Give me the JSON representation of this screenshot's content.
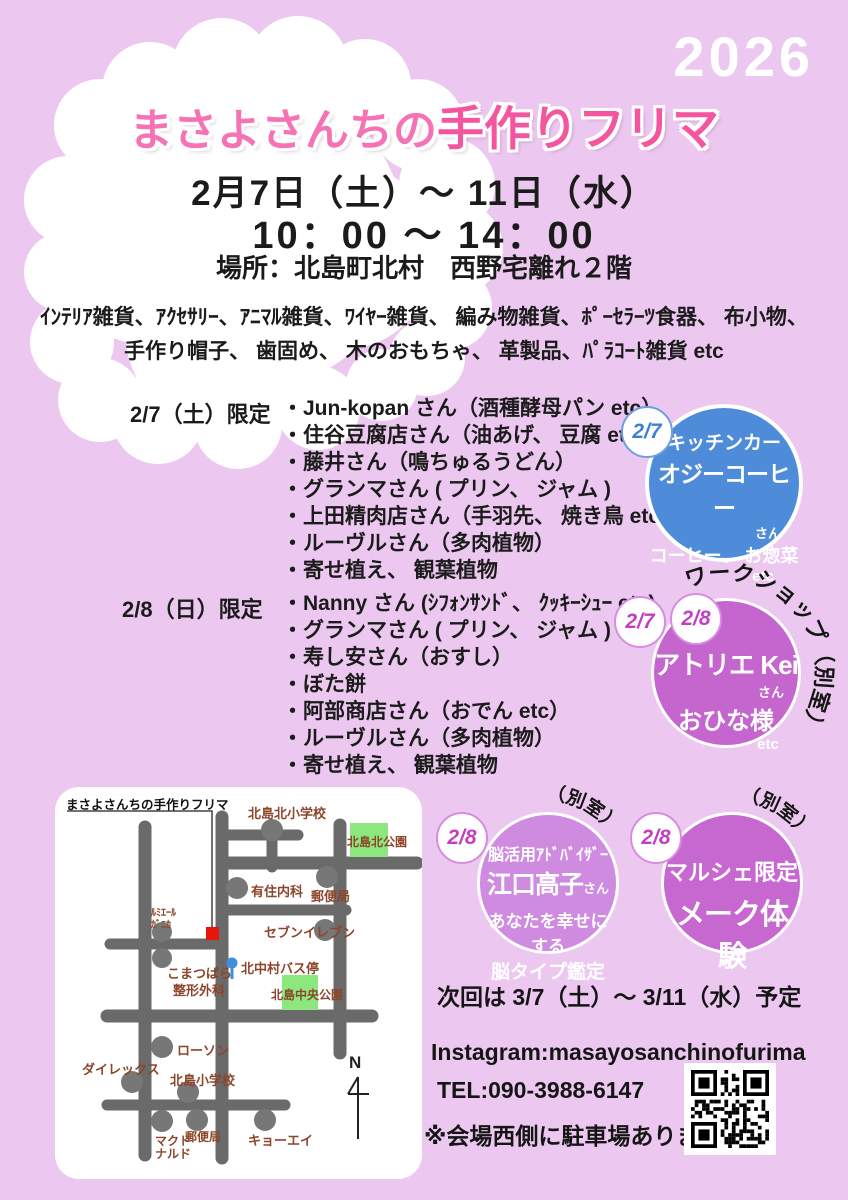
{
  "year": "2026",
  "title": {
    "part1": "まさよさんちの",
    "part2": "手作りフリマ"
  },
  "event": {
    "date_line": "2月7日（土）～ 11日（水）",
    "time_line": "10：00 ～ 14：00",
    "place_line": "場所：北島町北村　西野宅離れ２階"
  },
  "goods": {
    "line1": "ｲﾝﾃﾘｱ雑貨、ｱｸｾｻﾘｰ、ｱﾆﾏﾙ雑貨、ﾜｲﾔｰ雑貨、 編み物雑貨、ﾎﾟｰｾﾗｰﾂ食器、 布小物、",
    "line2": "手作り帽子、 歯固め、 木のおもちゃ、 革製品、ﾊﾟﾗｺｰﾄ雑貨 etc"
  },
  "sections": [
    {
      "label": "2/7（土）限定",
      "items": [
        "・Jun-kopan さん（酒種酵母パン etc）",
        "・住谷豆腐店さん（油あげ、 豆腐 etc）",
        "・藤井さん（鳴ちゅるうどん）",
        "・グランマさん ( プリン、 ジャム )",
        "・上田精肉店さん（手羽先、 焼き鳥 etc）",
        "・ルーヴルさん（多肉植物）",
        "・寄せ植え、 観葉植物"
      ]
    },
    {
      "label": "2/8（日）限定",
      "items": [
        "・Nanny さん (ｼﾌｫﾝｻﾝﾄﾞ、 ｸｯｷｰｼｭｰ etc)",
        "・グランマさん ( プリン、 ジャム )",
        "・寿し安さん（おすし）",
        "・ぼた餅",
        "・阿部商店さん（おでん etc）",
        "・ルーヴルさん（多肉植物）",
        "・寄せ植え、 観葉植物"
      ]
    }
  ],
  "bubbles": {
    "kitchen_car": {
      "badge": "2/7",
      "line1": "キッチンカー",
      "name": "オジーコーヒー",
      "suffix": "さん",
      "line2": "コーヒー、 お惣菜",
      "etc": "etc",
      "color": "#4e8cd9"
    },
    "workshop": {
      "badge1": "2/7",
      "badge2": "2/8",
      "arc_label": "ワークショップ（別室）",
      "name": "アトリエ Kei",
      "suffix": "さん",
      "line2": "おひな様",
      "etc": "etc",
      "color": "#c565ce"
    },
    "brain": {
      "badge": "2/8",
      "arc_label": "（別室）",
      "line1": "脳活用ｱﾄﾞﾊﾞｲｻﾞｰ",
      "name": "江口高子",
      "suffix": "さん",
      "line2": "あなたを幸せにする",
      "line3": "脳タイプ鑑定",
      "color": "#ce8be0"
    },
    "makeup": {
      "badge": "2/8",
      "arc_label": "（別室）",
      "line1": "マルシェ限定",
      "name": "メーク体験",
      "color": "#c767d0"
    }
  },
  "footer": {
    "next_line": "次回は 3/7（土）～ 3/11（水）予定",
    "instagram": "Instagram:masayosanchinofurima",
    "tel": "TEL:090-3988-6147",
    "parking_note": "※会場西側に駐車場あります"
  },
  "map": {
    "title": "まさよさんちの手作りフリマ",
    "labels": {
      "school_north": "北島北小学校",
      "park_north": "北島北公園",
      "clinic": "有住内科",
      "post_north": "郵便局",
      "lumiere1": "ﾙﾐｴｰﾙ",
      "lumiere2": "ｶﾞﾆｶ",
      "seven": "セブンイレブン",
      "komatsubara1": "こまつばら",
      "komatsubara2": "整形外科",
      "bus_stop": "北中村バス停",
      "park_center": "北島中央公園",
      "lawson": "ローソン",
      "dailex": "ダイレックス",
      "school_small": "北島小学校",
      "mcdonalds1": "マクド",
      "mcdonalds2": "ナルド",
      "post_south": "郵便局",
      "kyoei": "キョーエイ",
      "compass": "N"
    }
  },
  "colors": {
    "background": "#ecc8f0",
    "cloud": "#ffffff",
    "title_pink": "#f573b4",
    "title_pink_dark": "#f4559f",
    "kitchen_car_blue": "#4e8cd9",
    "workshop_magenta": "#c565ce",
    "brain_purple": "#ce8be0",
    "makeup_magenta": "#c767d0",
    "map_label_brown": "#8d452b",
    "park_green": "#8ce87e",
    "venue_red": "#e8150c",
    "bus_blue": "#3e8ee0",
    "road_gray": "#6a6a6a"
  }
}
